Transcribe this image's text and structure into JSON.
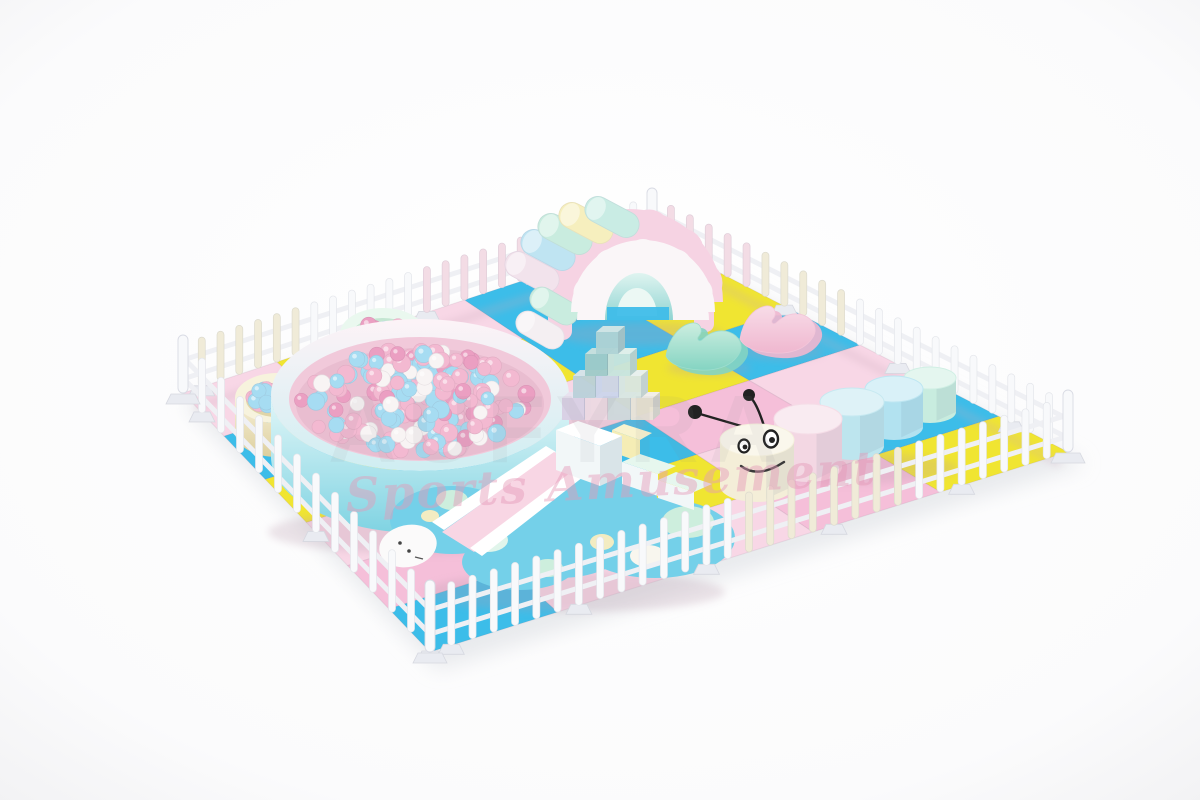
{
  "scene": {
    "description": "Pastel indoor soft play area: white picket fence around a pink, yellow and blue puzzle mat with Mickey-shaped ball pit, rainbow arch tunnel, wavy rockers, soft block pyramid, caterpillar stools and turtle slide",
    "background_color": "#fcfcfd"
  },
  "watermark": {
    "brand_text": "AUFYRA",
    "script_text": "Sports Amusement",
    "brand_color": "#84848e",
    "script_color": "#e59ab8"
  },
  "mat": {
    "columns": 6,
    "rows": 5,
    "palette": {
      "P": "#f5bfd9",
      "p": "#f8d7e6",
      "Y": "#f0e531",
      "B": "#3cbde9"
    },
    "tiles": [
      [
        "p",
        "Y",
        "B",
        "p",
        "B",
        "Y"
      ],
      [
        "B",
        "B",
        "Y",
        "P",
        "p",
        "P"
      ],
      [
        "p",
        "Y",
        "p",
        "B",
        "Y",
        "p"
      ],
      [
        "Y",
        "p",
        "B",
        "P",
        "B",
        "p"
      ],
      [
        "p",
        "B",
        "Y",
        "p",
        "P",
        "B"
      ]
    ]
  },
  "fence": {
    "picket_color": "#f8f9fb",
    "tint_pink": "#f3dce5",
    "tint_cream": "#f0ebd8",
    "rail_color": "#eff0f4",
    "foot_color": "#e9ebf1",
    "runs": [
      {
        "name": "left-top",
        "pickets": 26,
        "sections": [
          "cream",
          "white",
          "pink",
          "white"
        ]
      },
      {
        "name": "top-right",
        "pickets": 23,
        "sections": [
          "pink",
          "cream",
          "white",
          "white"
        ]
      },
      {
        "name": "left-bottom",
        "pickets": 14,
        "sections": [
          "white",
          "white"
        ]
      },
      {
        "name": "bottom-right",
        "pickets": 31,
        "sections": [
          "white",
          "white",
          "cream",
          "white"
        ]
      }
    ]
  },
  "equipment": {
    "ball_pit": {
      "rim_top": "#fdf3f7",
      "rim_bottom": "#cfeef2",
      "wall_top": "#e3f7f8",
      "wall_bottom": "#7fd3e2",
      "inner_wall": "#f1c9da",
      "inner_deep": "#e9bdd0",
      "ear_left_wall_top": "#f7f1d8",
      "ear_left_wall_bottom": "#ddcf9e",
      "ear_left_rim": "#f7f3dd",
      "ear_left_inner": "#e0d5a8",
      "ear_top_wall_top": "#e2f6ea",
      "ear_top_wall_bottom": "#b2e2cf",
      "ear_top_rim": "#eaf8ef",
      "ear_top_inner": "#c4e6d2",
      "ball_colors": [
        "#f3b9d1",
        "#a6dcf2",
        "#f8f4f4",
        "#eb9fc2"
      ],
      "ball_count_pool": 175,
      "ball_count_each_ear": 20,
      "ball_count_stream": 9
    },
    "arch": {
      "back_panel": "#f6d3e3",
      "front_panel": "#faf6f8",
      "tunnel_top": "#dff4f0",
      "tunnel_bottom": "#8fd4d2",
      "tunnel_exit": "#ecf8f4",
      "ground_through": "#3fbde9",
      "roller_colors": [
        "#f2e3ec",
        "#bfe4f2",
        "#c9ecdf",
        "#f6efbe",
        "#c9ece4"
      ],
      "side_roller_colors": [
        "#f4eff2",
        "#c9ecdf"
      ]
    },
    "rockers": [
      {
        "light": "#cdeee0",
        "dark": "#84d4c2"
      },
      {
        "light": "#f8dce8",
        "dark": "#efb7cf"
      }
    ],
    "blocks": {
      "colors": [
        "#d9cfe4",
        "#ecd8e2",
        "#cdd7db",
        "#e8e3d8",
        "#bad0d9",
        "#ccd4ea",
        "#d8e6e1",
        "#9fcac8",
        "#c8e4dc",
        "#aed2d4"
      ]
    },
    "caterpillar": {
      "head_color": "#f4eed8",
      "segment_colors": [
        "#f3d7e3",
        "#bde5ee",
        "#b2e2f0",
        "#c8ecdf"
      ],
      "face_color": "#222222"
    },
    "turtle": {
      "base_color": "#74d0e9",
      "spot_mint": "#cdeedd",
      "spot_cream": "#f3ecc2",
      "spot_white": "#f8f6ee",
      "ramp_color": "#f8d6e4",
      "block_color": "#f2f7f8",
      "wedge_color": "#f5edb5",
      "head_color": "#fbfafa"
    }
  }
}
